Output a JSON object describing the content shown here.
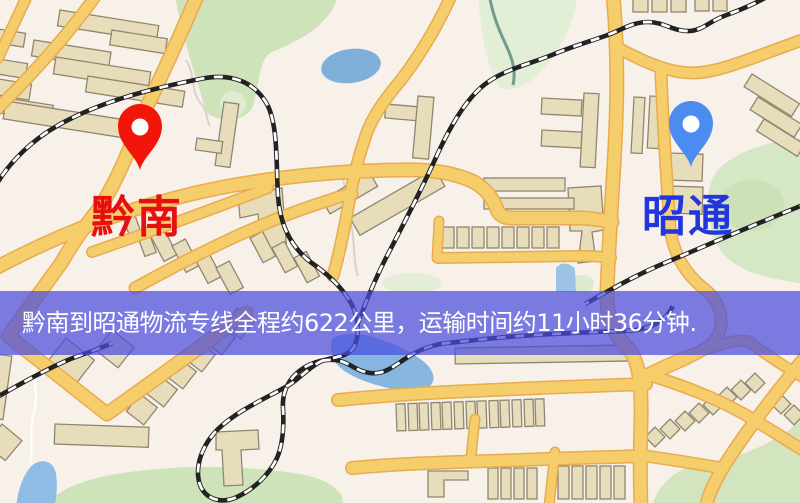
{
  "map": {
    "origin": {
      "name": "黔南",
      "pin_color": "#f2150a",
      "label_color": "#e80f0f"
    },
    "destination": {
      "name": "昭通",
      "pin_color": "#4a8cf0",
      "label_color": "#2336dd"
    },
    "colors": {
      "background": "#f7f1ea",
      "road_fill": "#f6cd6b",
      "road_casing": "#e8ab4f",
      "water": "#86b6e0",
      "park": "#cfe3bb",
      "railway": "#222222",
      "building": "#e8ddbb"
    }
  },
  "banner": {
    "text": "黔南到昭通物流专线全程约622公里，运输时间约11小时36分钟.",
    "background_color": "#4a4cde",
    "text_color": "#ffffff",
    "origin": "黔南",
    "destination": "昭通",
    "distance": "622公里",
    "duration": "11小时36分钟"
  }
}
